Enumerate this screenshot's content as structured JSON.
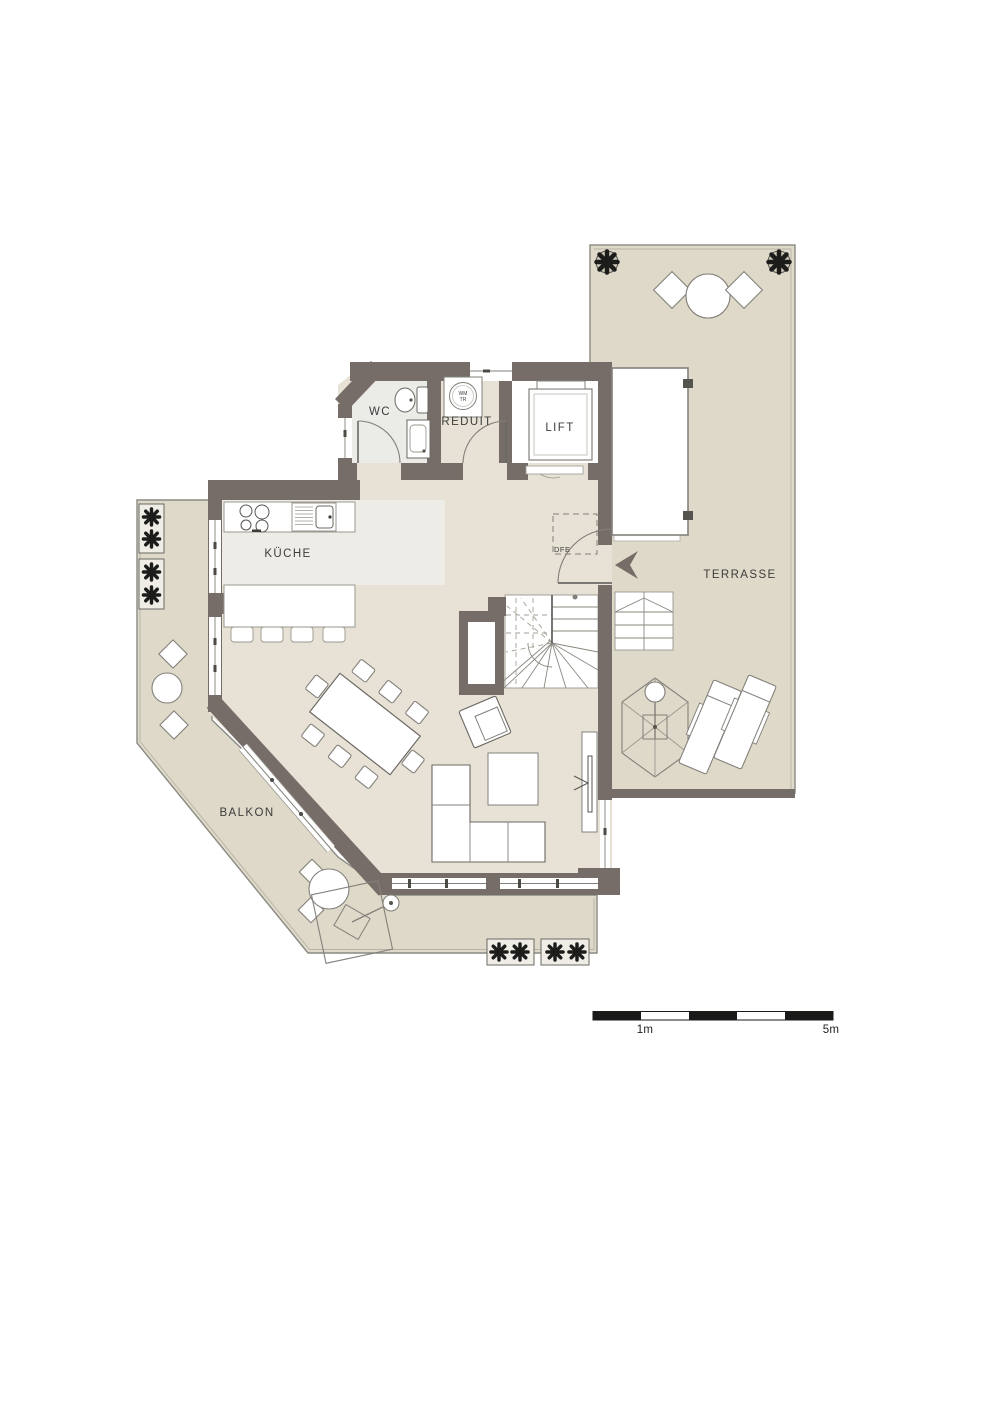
{
  "plan": {
    "rooms": {
      "wc": "WC",
      "reduit": "REDUIT",
      "lift": "LIFT",
      "kitchen": "KÜCHE",
      "terrace": "TERRASSE",
      "balcony": "BALKON",
      "roof_window": "DFE"
    },
    "appliance_labels": {
      "washer_line1": "WM",
      "washer_line2": "TR"
    },
    "scale_bar": {
      "first_mark": "1m",
      "last_mark": "5m"
    },
    "colors": {
      "wall": "#776d68",
      "interior_floor": "#e7e2d5",
      "outdoor_floor": "#ded9c9",
      "kitchen_floor": "#eeece6",
      "wc_floor": "#ebebe8",
      "scale_black": "#1a1a18",
      "plant_dark": "#1c1c1a"
    },
    "icons": {
      "plant": "plant-icon",
      "washing_machine": "washing-machine-icon",
      "entrance_arrow": "entrance-arrow-icon",
      "parasol": "parasol-icon",
      "cooktop": "cooktop-icon",
      "sink": "sink-icon",
      "toilet": "toilet-icon"
    }
  }
}
